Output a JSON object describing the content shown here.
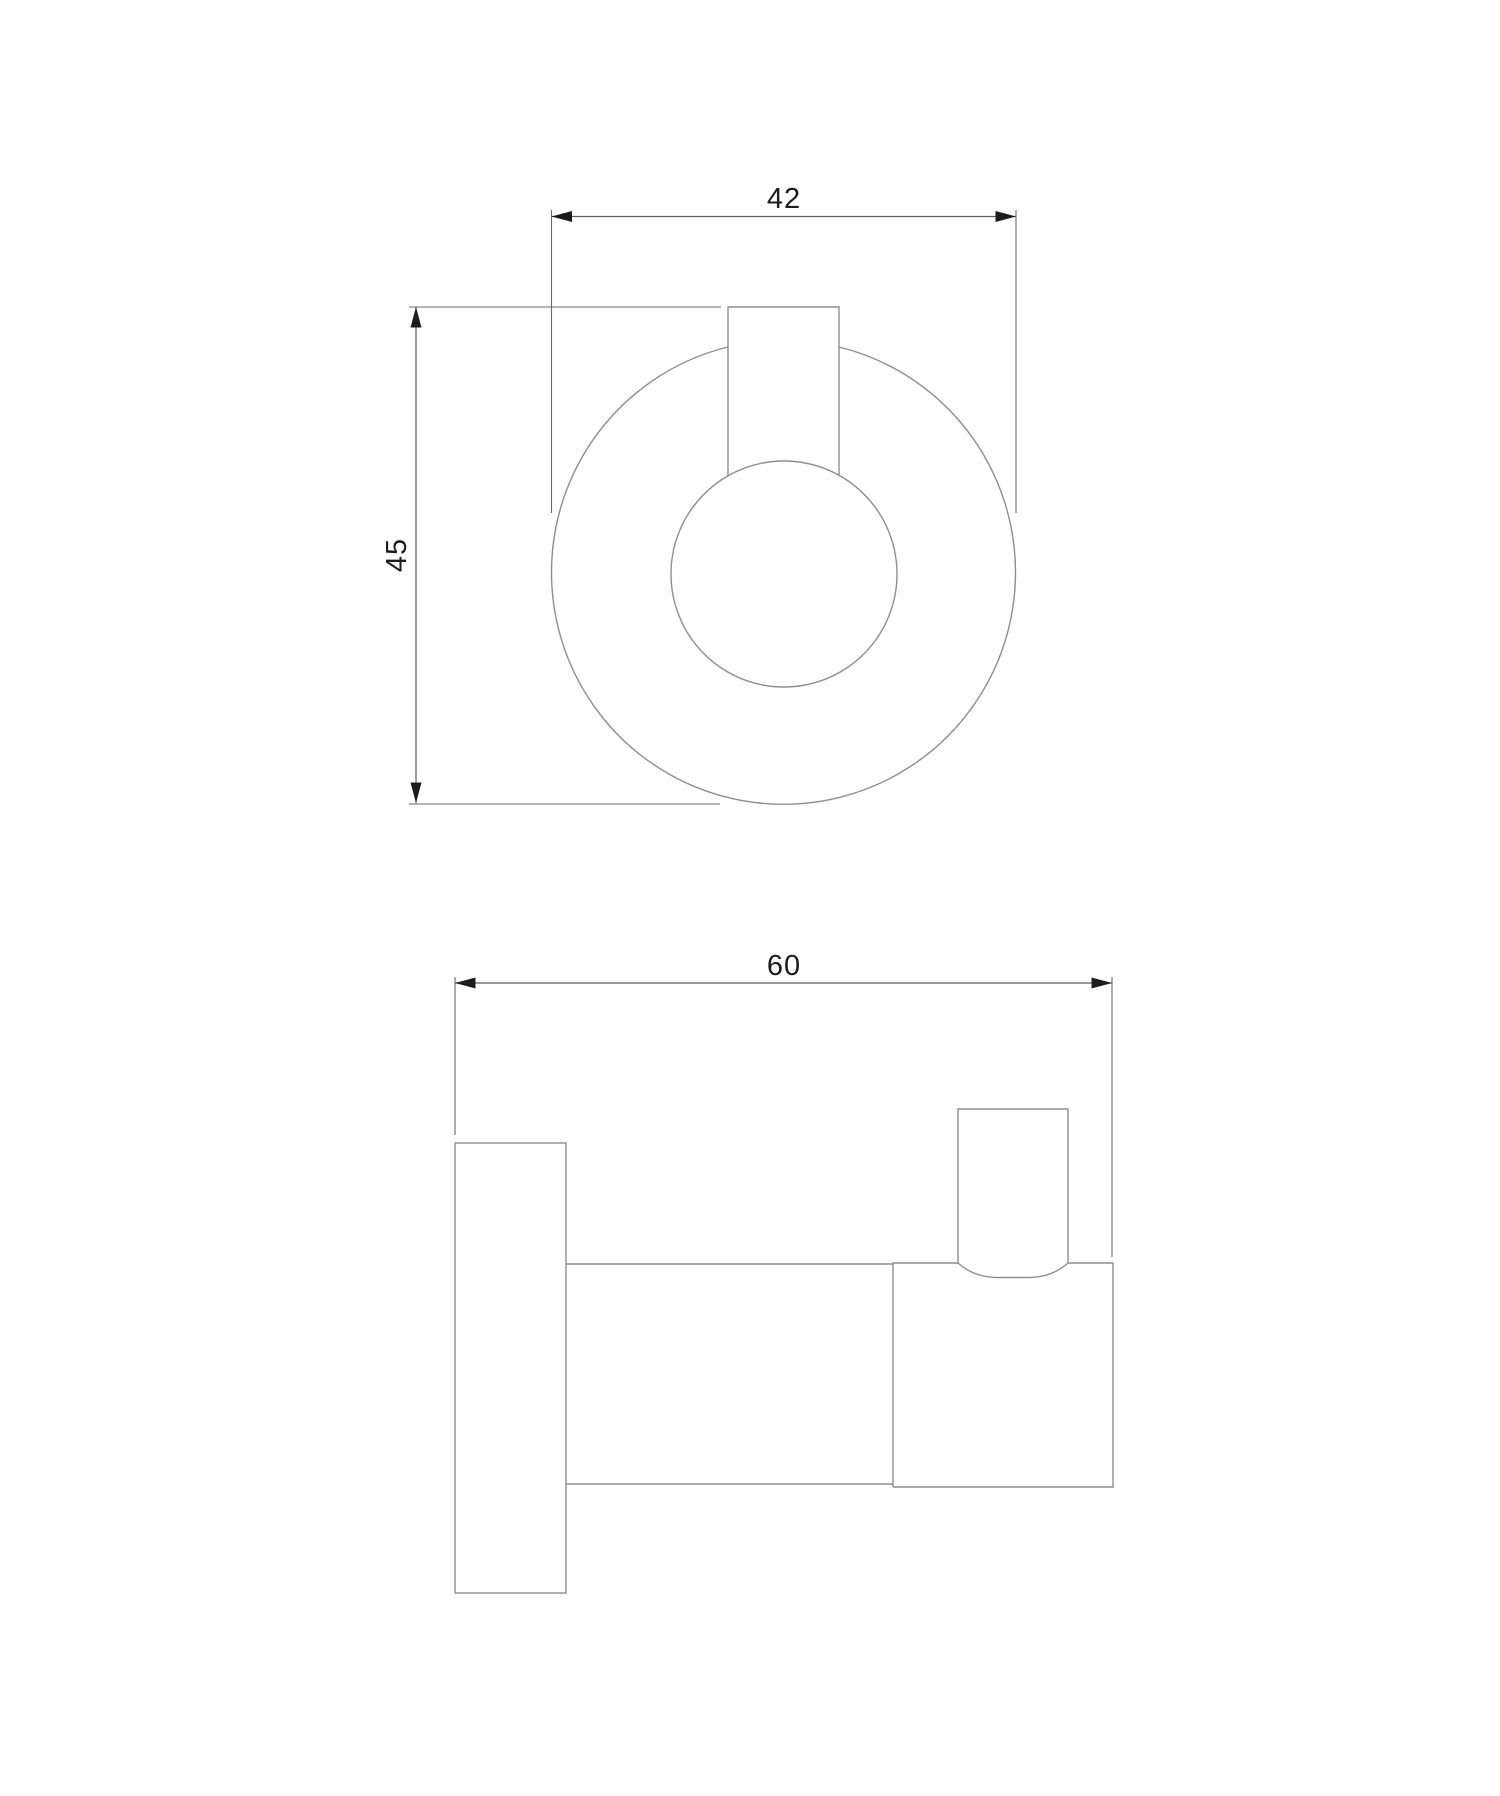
{
  "drawing": {
    "background_color": "#ffffff",
    "outline_color": "#8e8e8e",
    "dimension_line_color": "#5f5f5f",
    "text_color": "#1c1c1c",
    "views": {
      "front": {
        "dimensions": [
          {
            "id": "width",
            "value": "42",
            "orientation": "horizontal"
          },
          {
            "id": "height",
            "value": "45",
            "orientation": "vertical"
          }
        ]
      },
      "side": {
        "dimensions": [
          {
            "id": "depth",
            "value": "60",
            "orientation": "horizontal"
          }
        ]
      }
    }
  }
}
